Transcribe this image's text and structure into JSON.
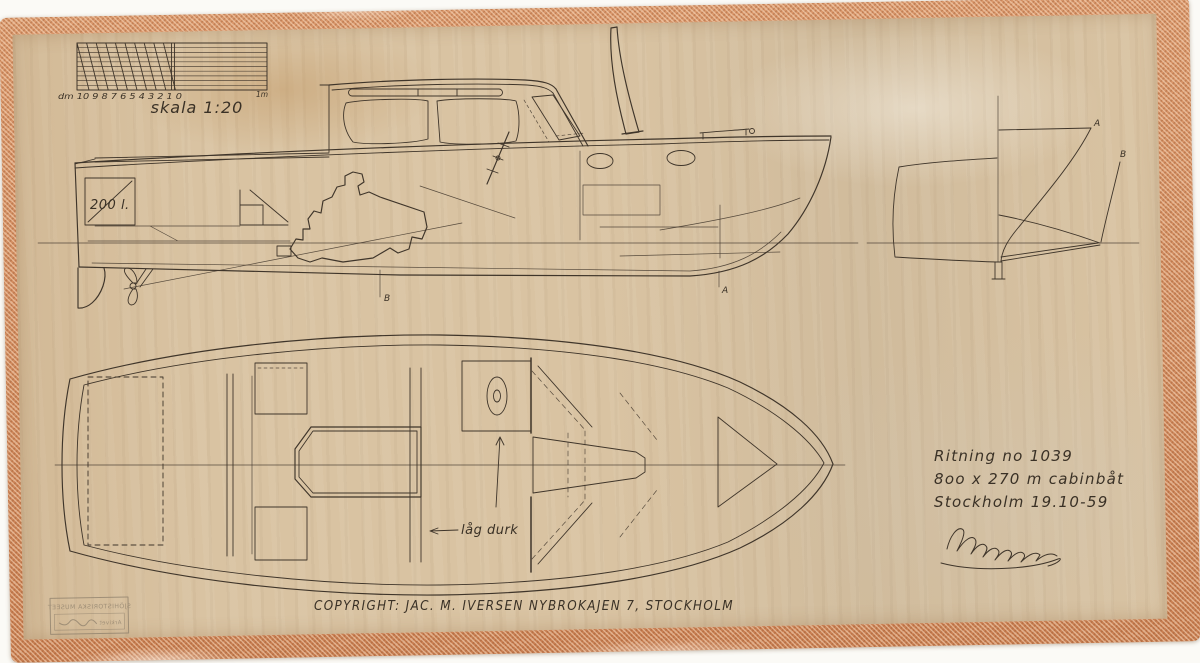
{
  "palette": {
    "background": "#fbfaf6",
    "paper": "#d9c3a2",
    "tape": "#cf8a5c",
    "ink": "#3f352a"
  },
  "scale_ruler": {
    "tick_labels": "dm 10 9 8 7 6 5 4 3 2 1 0",
    "meter_label": "1m",
    "caption": "skala 1:20"
  },
  "profile_view": {
    "tank_label": "200 l.",
    "marker_b": "B",
    "marker_a": "A"
  },
  "body_plan": {
    "marker_a": "A",
    "marker_b": "B"
  },
  "deck_plan": {
    "floor_label": "låg durk"
  },
  "title_block": {
    "line1": "Ritning no 1039",
    "line2": "8oo x 270 m cabinbåt",
    "line3": "Stockholm 19.10-59",
    "signature_name": "Iversen"
  },
  "footer": {
    "copyright": "COPYRIGHT: JAC. M. IVERSEN  NYBROKAJEN 7, STOCKHOLM"
  },
  "stamp": {
    "line1": "SJÖHISTORISKA MUSEET",
    "line2": "Arkivet"
  }
}
